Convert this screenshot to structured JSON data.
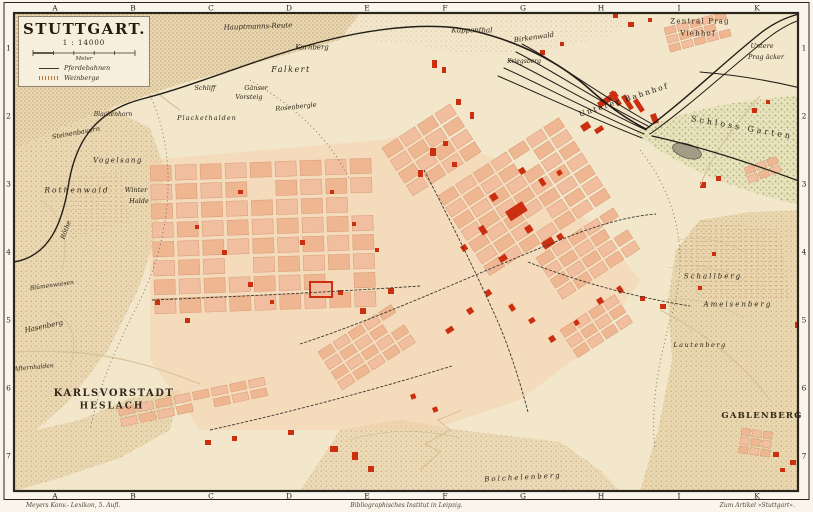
{
  "title_block": {
    "title": "STUTTGART.",
    "scale": "1 : 14000",
    "meter": "Meter",
    "legend": [
      {
        "symbol": "tram-line",
        "label": "Pferdebahnen"
      },
      {
        "symbol": "vineyard-hatch",
        "label": "Weinberge"
      }
    ]
  },
  "grid": {
    "columns": [
      "A",
      "B",
      "C",
      "D",
      "E",
      "F",
      "G",
      "H",
      "I",
      "K"
    ],
    "rows": [
      "1",
      "2",
      "3",
      "4",
      "5",
      "6",
      "7"
    ]
  },
  "credits": {
    "left": "Meyers Konv.- Lexikon, 5. Aufl.",
    "center": "Bibliographisches Institut in Leipzig.",
    "right": "Zum Artikel »Stuttgart«."
  },
  "colors": {
    "paper": "#f3e7cb",
    "urban_block": "#f1bf9f",
    "landmark_red": "#cc2f10",
    "railway_black": "#221d16",
    "garden_green": "#9aa86a"
  },
  "labels": [
    {
      "t": "Hauptmanns-Reute",
      "x": 258,
      "y": 27,
      "s": 7,
      "r": -2
    },
    {
      "t": "Kornberg",
      "x": 312,
      "y": 48,
      "s": 7
    },
    {
      "t": "Falkert",
      "x": 291,
      "y": 70,
      "s": 8,
      "sp": 1.5
    },
    {
      "t": "Kuppenthal",
      "x": 472,
      "y": 31,
      "s": 7
    },
    {
      "t": "Birkenwald",
      "x": 534,
      "y": 38,
      "s": 7,
      "r": -8
    },
    {
      "t": "Kriegsberg",
      "x": 524,
      "y": 62,
      "s": 6
    },
    {
      "t": "Zentral Prag",
      "x": 700,
      "y": 22,
      "s": 7,
      "sp": 1.2,
      "it": false
    },
    {
      "t": "Viehhof",
      "x": 698,
      "y": 34,
      "s": 7,
      "sp": 1.2,
      "it": false
    },
    {
      "t": "Untere",
      "x": 762,
      "y": 46,
      "s": 6.5
    },
    {
      "t": "Prag äcker",
      "x": 766,
      "y": 57,
      "s": 6.5
    },
    {
      "t": "Unterer Bahnhof",
      "x": 624,
      "y": 100,
      "s": 7.5,
      "r": -18,
      "sp": 2,
      "it": false,
      "c": "#1c1710"
    },
    {
      "t": "Schloss Garten",
      "x": 742,
      "y": 128,
      "s": 8,
      "r": 10,
      "sp": 3,
      "it": false
    },
    {
      "t": "Schliff",
      "x": 205,
      "y": 88,
      "s": 6.5
    },
    {
      "t": "Gänser",
      "x": 256,
      "y": 88,
      "s": 6.5
    },
    {
      "t": "Vorsteig",
      "x": 249,
      "y": 97,
      "s": 6.5
    },
    {
      "t": "Rosenbergle",
      "x": 296,
      "y": 107,
      "s": 6.5,
      "r": -6
    },
    {
      "t": "Blackenhorn",
      "x": 113,
      "y": 115,
      "s": 6
    },
    {
      "t": "Plackethalden",
      "x": 207,
      "y": 118,
      "s": 6.5,
      "sp": 1
    },
    {
      "t": "Steinenbauern",
      "x": 76,
      "y": 133,
      "s": 6.5,
      "r": -10
    },
    {
      "t": "Vogelsang",
      "x": 118,
      "y": 161,
      "s": 7,
      "sp": 1.5
    },
    {
      "t": "Rothenwald",
      "x": 77,
      "y": 190,
      "s": 7.5,
      "sp": 2
    },
    {
      "t": "Winter",
      "x": 136,
      "y": 190,
      "s": 6.5
    },
    {
      "t": "Halde",
      "x": 139,
      "y": 201,
      "s": 6.5
    },
    {
      "t": "Röthe",
      "x": 66,
      "y": 230,
      "s": 6.5,
      "r": -70
    },
    {
      "t": "Blümenwiesen",
      "x": 52,
      "y": 286,
      "s": 6,
      "r": -8
    },
    {
      "t": "Hasenberg",
      "x": 44,
      "y": 327,
      "s": 7,
      "r": -12
    },
    {
      "t": "Afternhalden",
      "x": 34,
      "y": 368,
      "s": 6,
      "r": -5
    },
    {
      "t": "KARLSVORSTADT",
      "x": 114,
      "y": 394,
      "s": 10,
      "sp": 1.5,
      "it": false,
      "f": "caps"
    },
    {
      "t": "HESLACH",
      "x": 112,
      "y": 407,
      "s": 9,
      "sp": 2,
      "it": false,
      "f": "caps"
    },
    {
      "t": "GABLENBERG",
      "x": 762,
      "y": 416,
      "s": 8.5,
      "sp": 1.2,
      "it": false,
      "f": "caps"
    },
    {
      "t": "Schallberg",
      "x": 713,
      "y": 277,
      "s": 7,
      "sp": 2
    },
    {
      "t": "Ameisenberg",
      "x": 738,
      "y": 305,
      "s": 7,
      "sp": 2
    },
    {
      "t": "Lautenberg",
      "x": 700,
      "y": 345,
      "s": 6.5,
      "sp": 1.5
    },
    {
      "t": "Bolchelenberg",
      "x": 523,
      "y": 478,
      "s": 7,
      "sp": 2,
      "r": -3
    }
  ]
}
